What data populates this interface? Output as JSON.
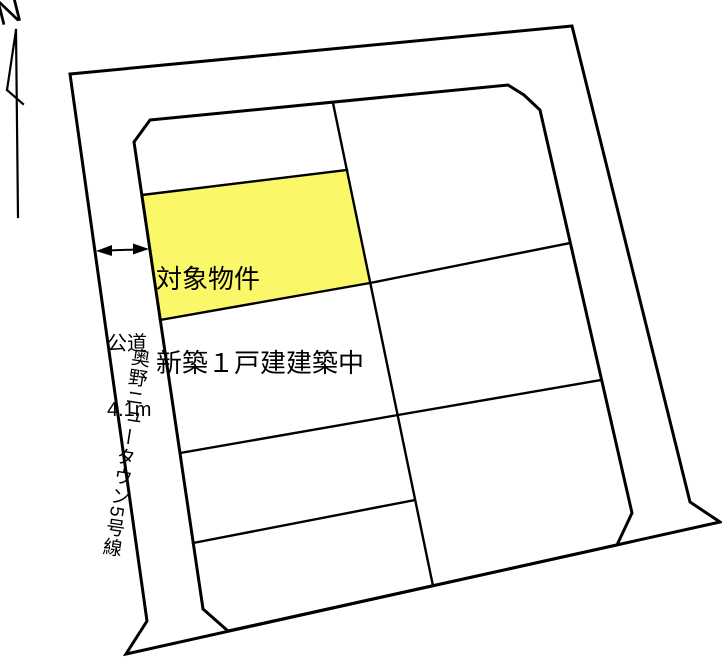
{
  "compass": {
    "label": "N"
  },
  "target_parcel": {
    "label_line1": "対象物件",
    "label_line2": "新築１戸建建築中",
    "fill": "#faf768"
  },
  "road": {
    "surface_label": "公道",
    "width_label": "4.1m",
    "name": "奥野ニュータウン5号線"
  },
  "colors": {
    "line": "#000000",
    "background": "#ffffff",
    "highlight": "#faf768"
  }
}
